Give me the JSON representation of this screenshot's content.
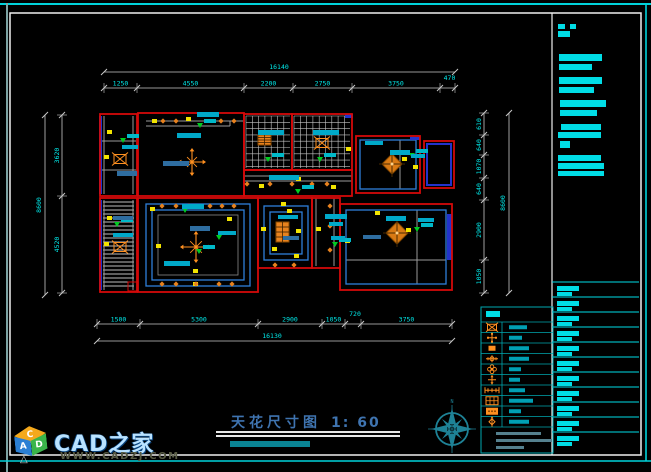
{
  "title": {
    "text": "天花尺寸图",
    "scale": "1: 60"
  },
  "watermark": {
    "brand": "CAD之家",
    "url": "WWW.CADZJ.COM",
    "cube_letters": {
      "top": "C",
      "left": "A",
      "right": "D"
    }
  },
  "compass": {
    "north": "N"
  },
  "dimensions": {
    "top": {
      "overall": "16140",
      "segments": [
        "1250",
        "4550",
        "2200",
        "2750",
        "3750",
        "470"
      ]
    },
    "bottom": {
      "overall": "16130",
      "segments": [
        "1500",
        "5300",
        "2900",
        "1050",
        "720",
        "3750"
      ]
    },
    "left": {
      "overall": "8600",
      "segments": [
        "3620",
        "4520"
      ]
    },
    "right": {
      "overall": "8600",
      "segments": [
        "610",
        "640",
        "1070",
        "640",
        "2900",
        "1050"
      ]
    }
  },
  "legend": {
    "rows": [
      {
        "icon": "crossed-box-icon"
      },
      {
        "icon": "cross-lamp-icon"
      },
      {
        "icon": "rect-light-icon"
      },
      {
        "icon": "crosshair-lamp-icon"
      },
      {
        "icon": "flower-lamp-icon"
      },
      {
        "icon": "four-arrow-lamp-icon"
      },
      {
        "icon": "tick-line-icon"
      },
      {
        "icon": "grid-light-icon"
      },
      {
        "icon": "panel-light-icon"
      },
      {
        "icon": "diamond-arrow-icon"
      }
    ]
  },
  "colors": {
    "frame_cyan": "#00d2da",
    "frame_white": "#f0f0f0",
    "wall_red": "#d40909",
    "line_gray": "#9a9a9a",
    "dim_line": "#c8c8c8",
    "dim_text": "#00e8e8",
    "text_bar": "#00dde6",
    "label_cyan": "#00a9c9",
    "label_blue": "#2e6da0",
    "accent_blue": "#2233cc",
    "ceiling_blue": "#2e7fd9",
    "light_yellow": "#f2e400",
    "symbol_orange": "#ff9020",
    "marker_green": "#00cc22",
    "compass_teal": "#1e8296",
    "legend_border": "#00a8b0",
    "footer_gray": "#55808e",
    "subtitle_teal": "#0a8494"
  }
}
